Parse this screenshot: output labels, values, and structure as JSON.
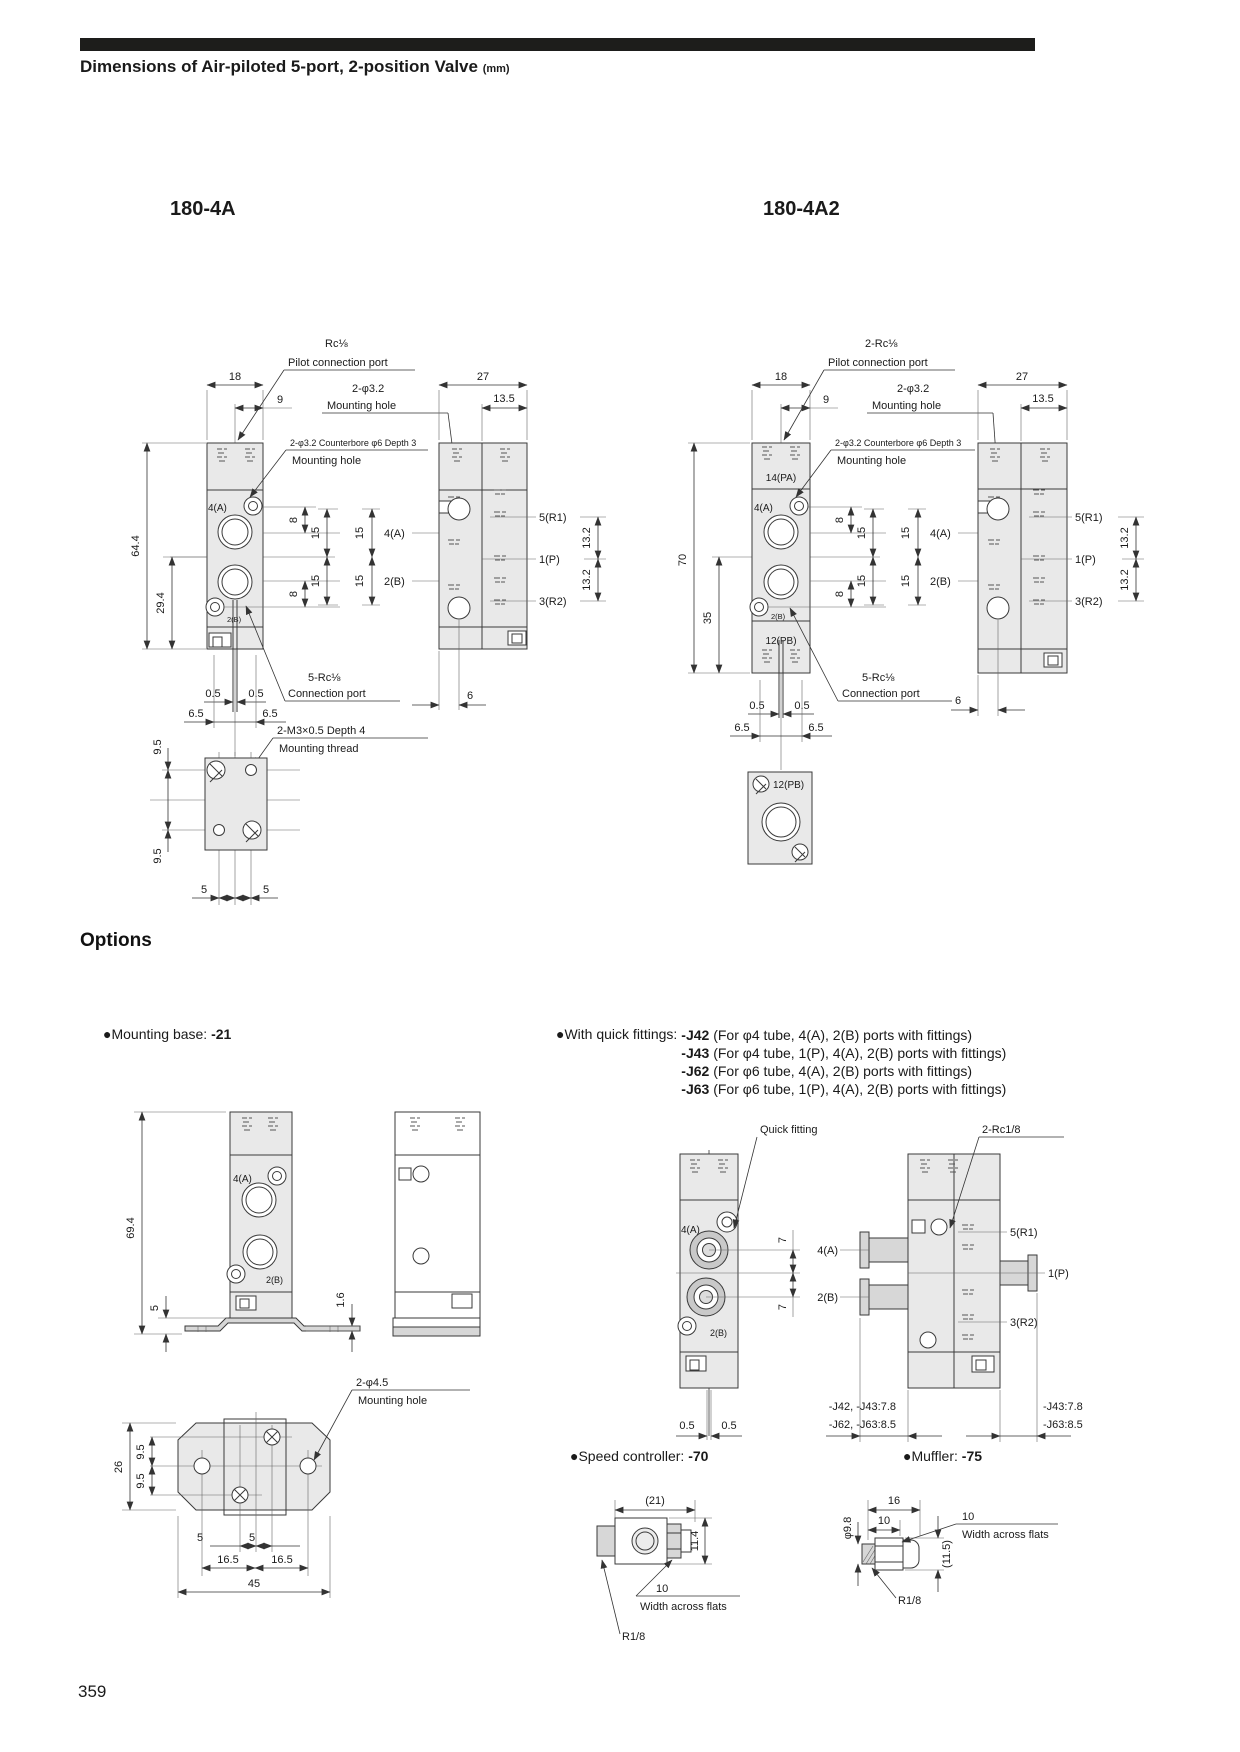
{
  "page": {
    "title": "Dimensions of Air-piloted 5-port, 2-position Valve",
    "unit": "(mm)",
    "number": "359"
  },
  "m1": {
    "name": "180-4A",
    "pilot_l1": "Rc⅛",
    "pilot_l2": "Pilot connection port",
    "mh_l1": "2-φ3.2",
    "mh_l2": "Mounting hole",
    "cb_l1": "2-φ3.2 Counterbore φ6 Depth 3",
    "cb_l2": "Mounting hole",
    "conn_l1": "5-Rc⅛",
    "conn_l2": "Connection port",
    "thr_l1": "2-M3×0.5 Depth 4",
    "thr_l2": "Mounting thread",
    "w": "18",
    "off": "9",
    "sw": "27",
    "soff": "13.5",
    "h": "64.4",
    "h2": "29.4",
    "a": "4(A)",
    "b": "2(B)",
    "r1": "5(R1)",
    "p": "1(P)",
    "r2": "3(R2)",
    "d8": "8",
    "d15": "15",
    "d132": "13.2",
    "d05": "0.5",
    "d65": "6.5",
    "d6": "6",
    "d95": "9.5",
    "d5": "5"
  },
  "m2": {
    "name": "180-4A2",
    "pilot_l1": "2-Rc⅛",
    "pilot_l2": "Pilot connection port",
    "mh_l1": "2-φ3.2",
    "mh_l2": "Mounting hole",
    "cb_l1": "2-φ3.2 Counterbore φ6 Depth 3",
    "cb_l2": "Mounting hole",
    "conn_l1": "5-Rc⅛",
    "conn_l2": "Connection port",
    "w": "18",
    "off": "9",
    "sw": "27",
    "soff": "13.5",
    "h": "70",
    "h2": "35",
    "pa": "14(PA)",
    "pb": "12(PB)",
    "a": "4(A)",
    "b": "2(B)",
    "r1": "5(R1)",
    "p": "1(P)",
    "r2": "3(R2)",
    "d8": "8",
    "d15": "15",
    "d132": "13.2",
    "d05": "0.5",
    "d65": "6.5",
    "d6": "6"
  },
  "options": {
    "heading": "Options",
    "bullet": "●",
    "mounting_base_label": "Mounting base: ",
    "mounting_base_code": "-21",
    "fittings_label": "With quick fittings: ",
    "fittings": [
      {
        "code": "-J42",
        "desc": " (For φ4 tube, 4(A), 2(B) ports with fittings)"
      },
      {
        "code": "-J43",
        "desc": " (For φ4 tube, 1(P), 4(A), 2(B) ports with fittings)"
      },
      {
        "code": "-J62",
        "desc": " (For φ6 tube, 4(A), 2(B) ports with fittings)"
      },
      {
        "code": "-J63",
        "desc": " (For φ6 tube, 1(P), 4(A), 2(B) ports with fittings)"
      }
    ],
    "speed_label": "Speed controller: ",
    "speed_code": "-70",
    "muffler_label": "Muffler: ",
    "muffler_code": "-75"
  },
  "base": {
    "h": "69.4",
    "d5": "5",
    "d16": "1.6",
    "a": "4(A)",
    "b": "2(B)",
    "mh_l1": "2-φ4.5",
    "mh_l2": "Mounting hole",
    "d26": "26",
    "d95": "9.5",
    "d5b": "5",
    "d165": "16.5",
    "d45": "45"
  },
  "qf": {
    "label": "Quick fitting",
    "rc": "2-Rc1/8",
    "a": "4(A)",
    "b": "2(B)",
    "r1": "5(R1)",
    "p": "1(P)",
    "r2": "3(R2)",
    "d7": "7",
    "d05": "0.5",
    "jl1": "-J42, -J43:7.8",
    "jl2": "-J62, -J63:8.5",
    "jr1": "-J43:7.8",
    "jr2": "-J63:8.5"
  },
  "sc": {
    "d21": "(21)",
    "d114": "11.4",
    "d10": "10",
    "waf": "Width across flats",
    "r18": "R1/8"
  },
  "mf": {
    "d16": "16",
    "d10": "10",
    "d10b": "10",
    "waf": "Width across flats",
    "d98": "φ9.8",
    "d115": "(11.5)",
    "r18": "R1/8"
  }
}
